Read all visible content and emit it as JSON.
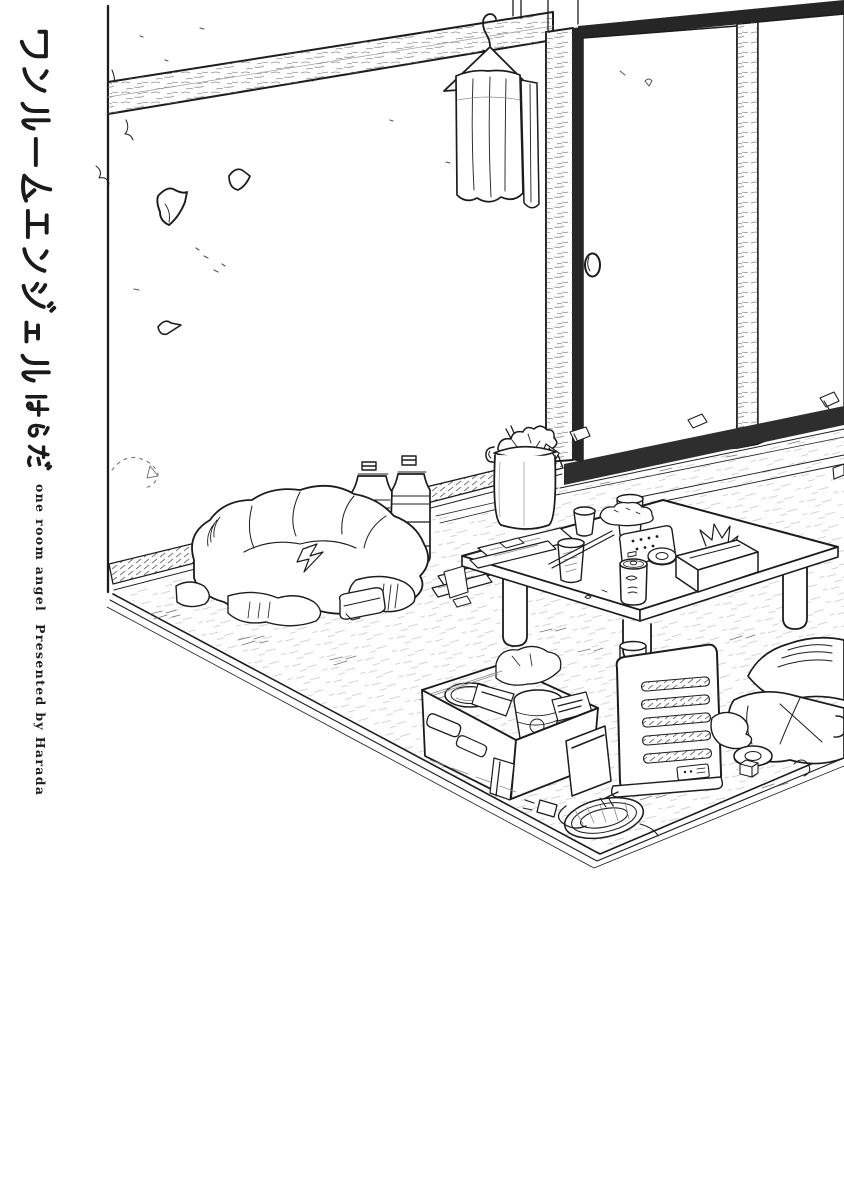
{
  "page": {
    "width": 844,
    "height": 1200,
    "background": "#ffffff",
    "ink": "#1c1c1c",
    "texture_gray": "#777777"
  },
  "cover": {
    "title_ja": "ワンルームエンジェル",
    "author_ja": "はらだ",
    "title_en": "one room angel",
    "credit_en": "Presented by Harada"
  },
  "illustration": {
    "scene": "messy-one-room-apartment",
    "objects": [
      "wall",
      "wood-beam",
      "wood-pillar",
      "sliding-doors",
      "door-catch",
      "wire-hanger",
      "hanging-towels",
      "wall-peeling-patches",
      "pet-bottles",
      "trash-pail-with-chopsticks",
      "clothes-blanket-pile",
      "low-table",
      "glasses",
      "drink-can",
      "remote-control",
      "tissue-box",
      "chopsticks",
      "tape-roll",
      "papers",
      "snack-pouch",
      "snack-cardboard-box",
      "fan-heater",
      "power-cord-coil-and-plug",
      "futon-cushion-pile",
      "tatami-rug",
      "floor-scraps"
    ]
  }
}
